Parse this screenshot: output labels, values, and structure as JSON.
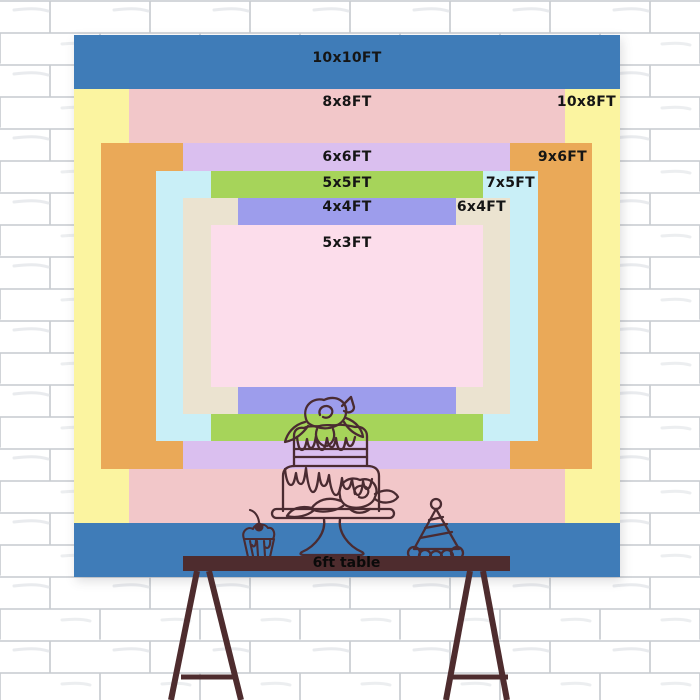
{
  "sizes": {
    "s10x10": {
      "label": "10x10FT",
      "color": "#3F7CB8"
    },
    "s10x8": {
      "label": "10x8FT",
      "color": "#FBF4A0"
    },
    "s8x8": {
      "label": "8x8FT",
      "color": "#F2C7C9"
    },
    "s9x6": {
      "label": "9x6FT",
      "color": "#EAA958"
    },
    "s6x6": {
      "label": "6x6FT",
      "color": "#DABFEF"
    },
    "s7x5": {
      "label": "7x5FT",
      "color": "#C9EFF7"
    },
    "s5x5": {
      "label": "5x5FT",
      "color": "#A6D45A"
    },
    "s6x4": {
      "label": "6x4FT",
      "color": "#EBE3D0"
    },
    "s4x4": {
      "label": "4x4FT",
      "color": "#9D9DEC"
    },
    "s5x3": {
      "label": "5x3FT",
      "color": "#FCDDEB"
    }
  },
  "table": {
    "label": "6ft table",
    "color": "#4E2C2E"
  },
  "easel": {
    "color": "#4E2C2E"
  },
  "art": {
    "line_color": "#4A2B31",
    "items": [
      "tiered-cake",
      "cupcake",
      "party-hat"
    ]
  }
}
